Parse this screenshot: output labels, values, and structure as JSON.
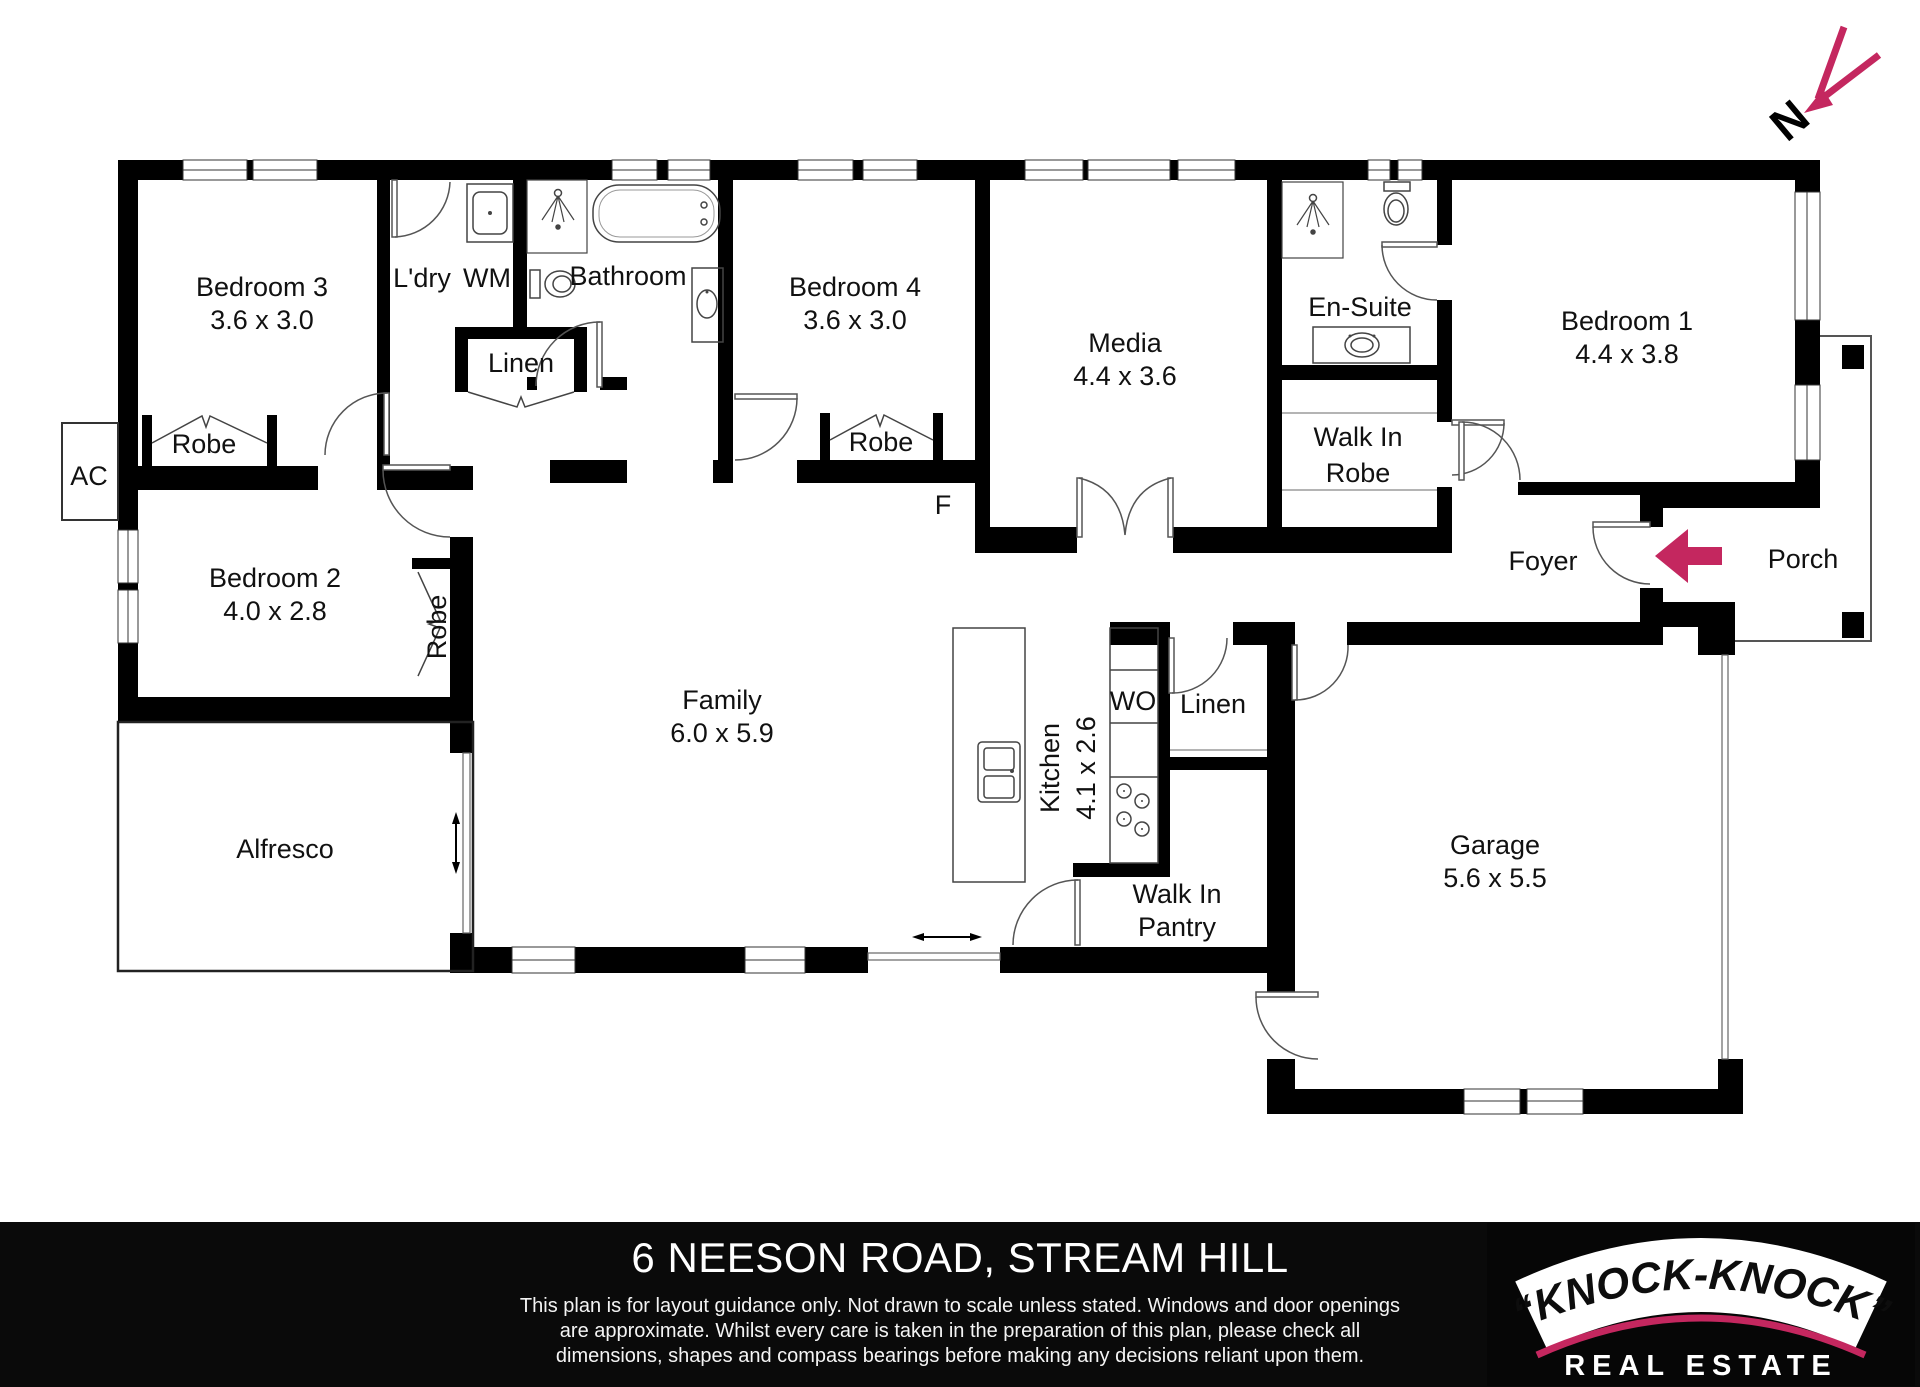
{
  "colors": {
    "accent": "#C4275F",
    "wall": "#000000",
    "footer_bg": "#0A0A0A"
  },
  "compass": {
    "north_label": "N"
  },
  "rooms": [
    {
      "name": "bedroom-3",
      "label": "Bedroom 3",
      "dims": "3.6 x 3.0"
    },
    {
      "name": "bedroom-4",
      "label": "Bedroom 4",
      "dims": "3.6 x 3.0"
    },
    {
      "name": "media",
      "label": "Media",
      "dims": "4.4 x 3.6"
    },
    {
      "name": "bedroom-1",
      "label": "Bedroom 1",
      "dims": "4.4 x 3.8"
    },
    {
      "name": "bedroom-2",
      "label": "Bedroom 2",
      "dims": "4.0 x 2.8"
    },
    {
      "name": "family",
      "label": "Family",
      "dims": "6.0 x 5.9"
    },
    {
      "name": "kitchen",
      "label": "Kitchen",
      "dims": "4.1 x 2.6"
    },
    {
      "name": "garage",
      "label": "Garage",
      "dims": "5.6 x 5.5"
    }
  ],
  "areas": {
    "ldry": "L'dry",
    "wm": "WM",
    "bathroom": "Bathroom",
    "linen_hall": "Linen",
    "robe_bed3": "Robe",
    "robe_bed4": "Robe",
    "robe_bed2": "Robe",
    "ac": "AC",
    "fridge": "F",
    "ensuite": "En-Suite",
    "wir_line1": "Walk In",
    "wir_line2": "Robe",
    "foyer": "Foyer",
    "porch": "Porch",
    "wo": "WO",
    "linen_kitchen": "Linen",
    "wip_line1": "Walk In",
    "wip_line2": "Pantry",
    "alfresco": "Alfresco"
  },
  "footer": {
    "title": "6 NEESON ROAD, STREAM HILL",
    "disclaimer_line1": "This plan is for layout guidance only. Not drawn to scale unless stated. Windows and door openings",
    "disclaimer_line2": "are approximate. Whilst every care is taken in the preparation of this plan, please check all",
    "disclaimer_line3": "dimensions, shapes and compass bearings before making any decisions reliant upon them."
  },
  "logo": {
    "brand": "“KNOCK-KNOCK”",
    "tagline": "REAL ESTATE"
  }
}
